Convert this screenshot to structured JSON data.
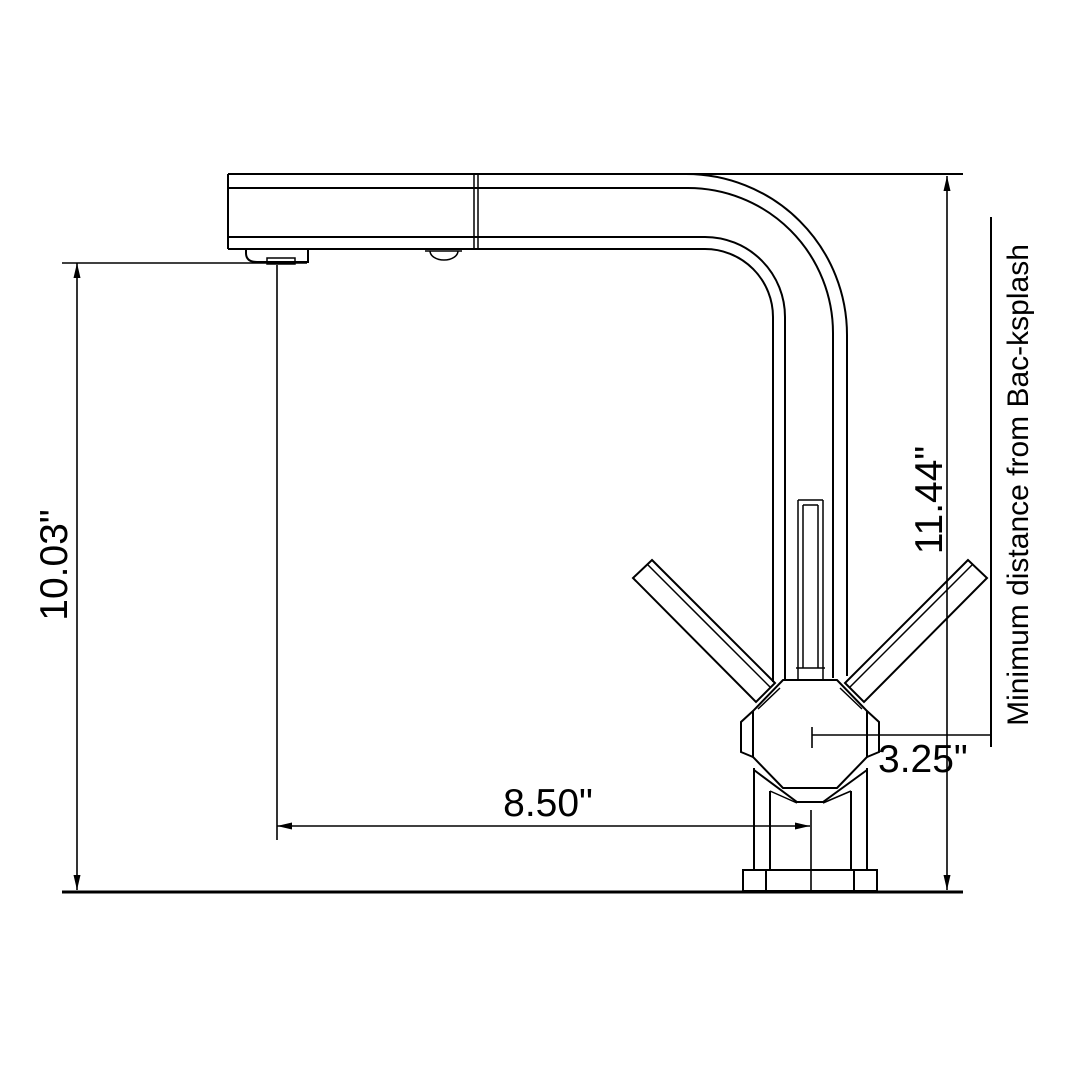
{
  "drawing": {
    "type": "faucet-dimension-diagram",
    "background_color": "#ffffff",
    "line_color": "#000000",
    "labels": {
      "overall_height": "10.03\"",
      "spout_reach": "8.50\"",
      "center_to_backsplash": "3.25\"",
      "spout_top_height": "11.44\"",
      "backsplash_note": "Minimum distance from Bac-ksplash"
    }
  }
}
